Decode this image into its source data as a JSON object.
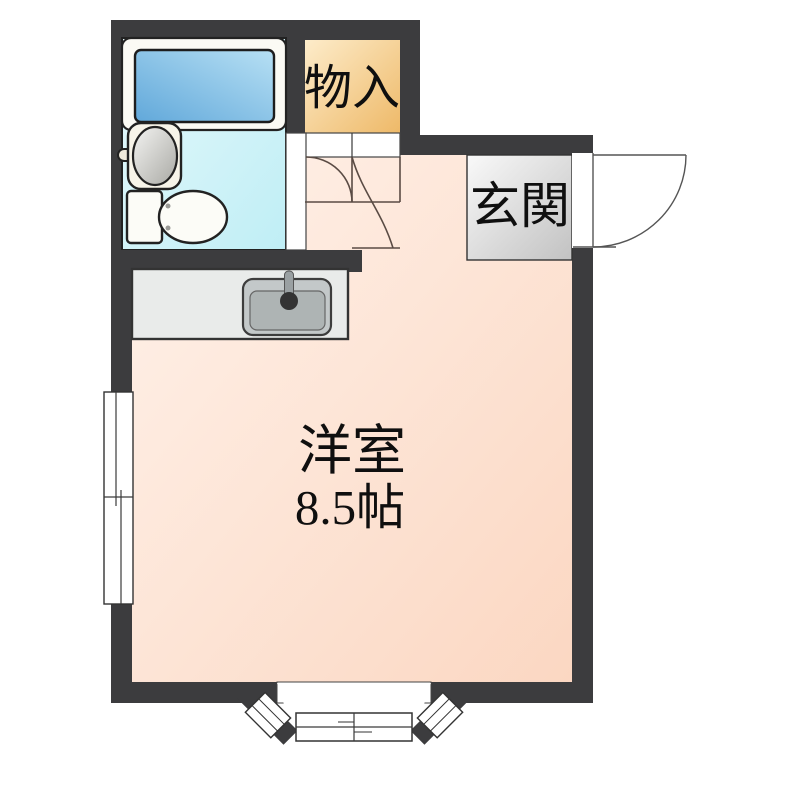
{
  "floorplan": {
    "closet": {
      "label": "物入"
    },
    "entrance": {
      "label": "玄関"
    },
    "main_room": {
      "label": "洋室",
      "area_label": "8.5帖"
    },
    "bathroom": {
      "fixtures": [
        "bathtub",
        "washbasin",
        "toilet"
      ]
    },
    "kitchen": {
      "fixtures": [
        "kitchen-sink",
        "faucet"
      ]
    },
    "openings": [
      "entrance-door",
      "room-door",
      "closet-door",
      "bathroom-door",
      "bay-window",
      "sliding-window"
    ],
    "colors": {
      "wall": "#3c3c3e",
      "room_light": "#fff2ea",
      "room_dark": "#fbd7c2",
      "bath_light": "#e6f9fc",
      "bath_dark": "#bfeef5",
      "tub_light": "#b7e0f4",
      "tub_dark": "#61a8da",
      "closet_light": "#fdecca",
      "closet_dark": "#eeb968",
      "entrance_light": "#f9f9f9",
      "entrance_dark": "#c2c2c2",
      "counter": "#e9ebea",
      "sink_outer": "#c3c8c9",
      "sink_inner": "#aeb4b4",
      "door_line": "#5a4b44"
    }
  }
}
